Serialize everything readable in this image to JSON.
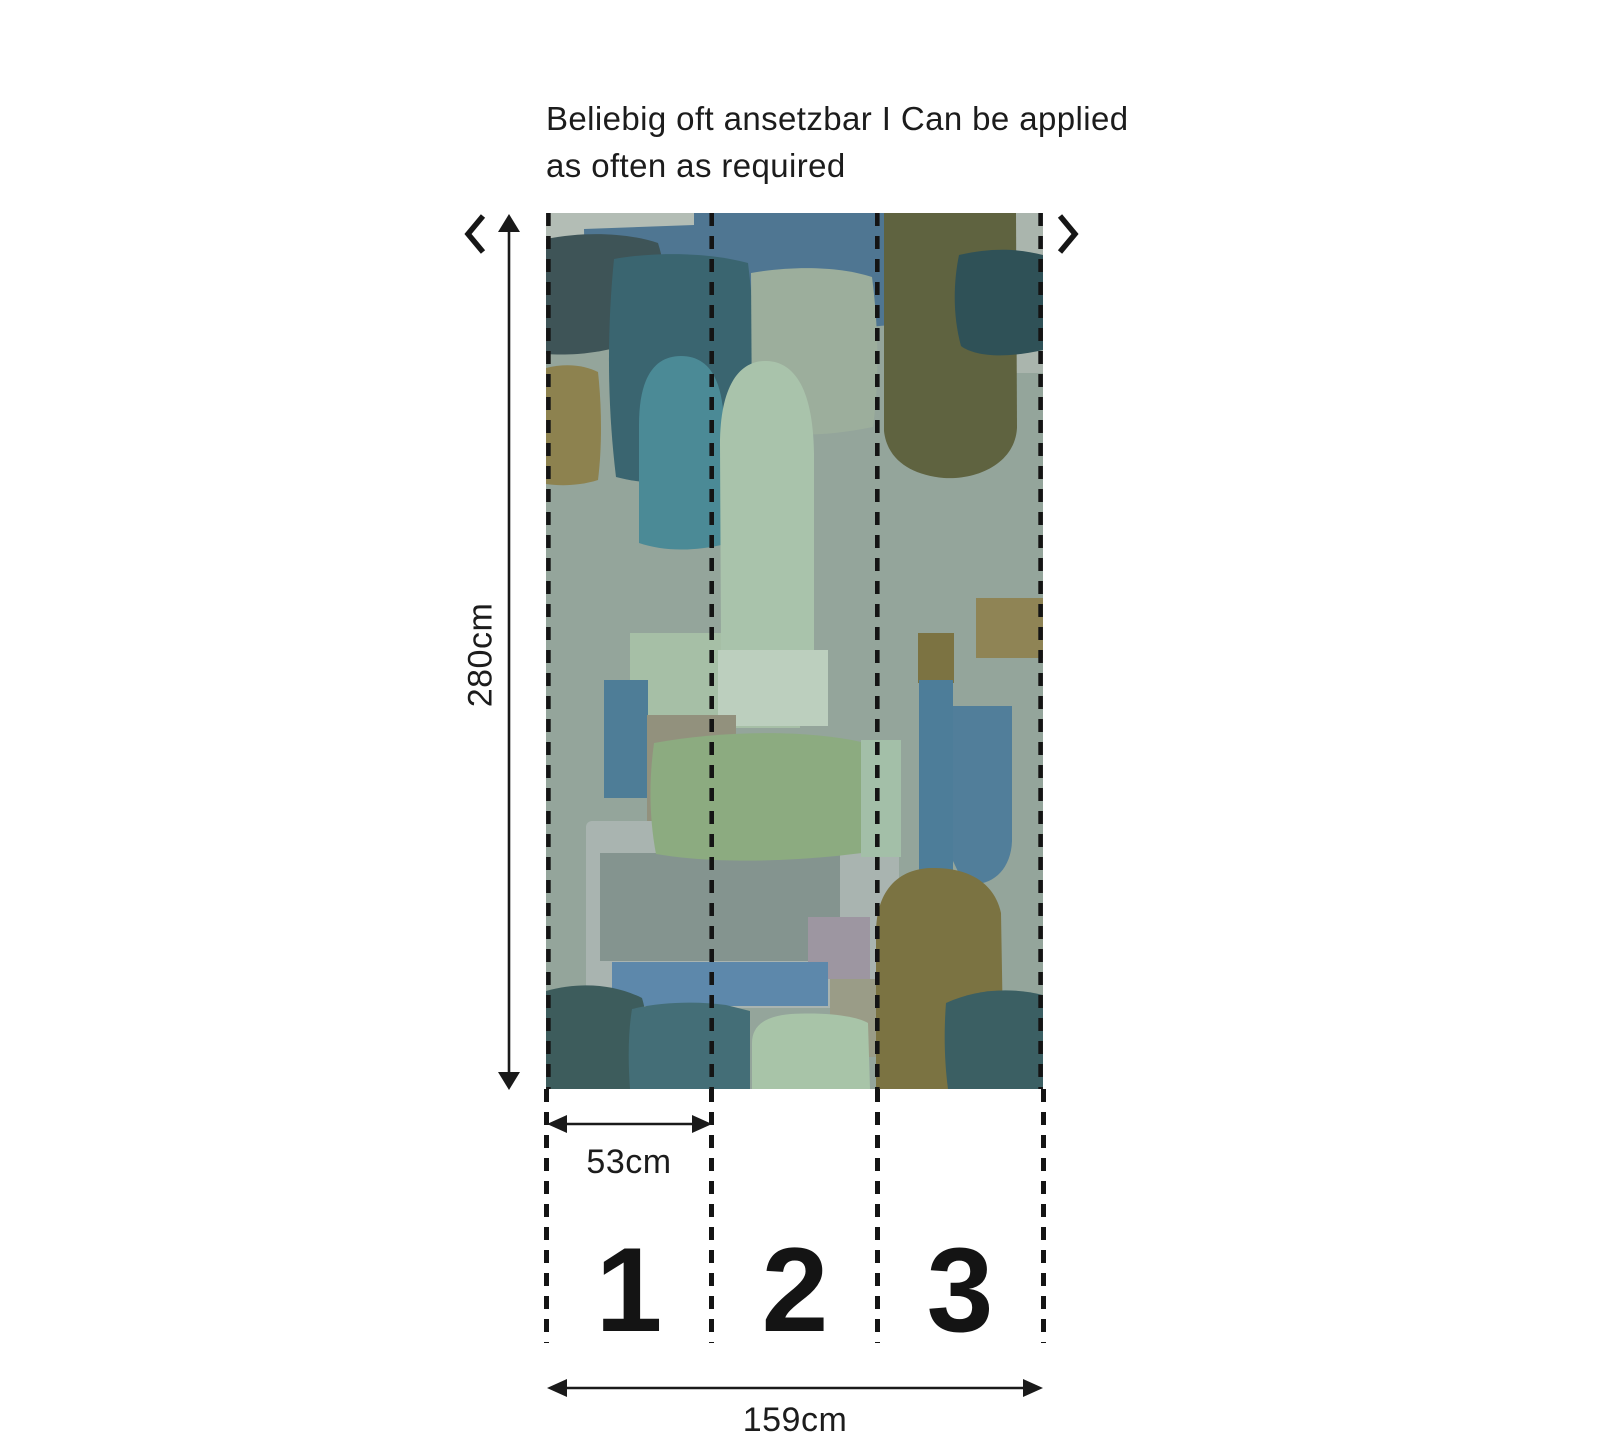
{
  "note": {
    "line1": "Beliebig oft ansetzbar I Can be applied",
    "line2": "as often as required"
  },
  "dimensions": {
    "height_label": "280cm",
    "strip_width_label": "53cm",
    "total_width_label": "159cm"
  },
  "panels": [
    {
      "number": "1"
    },
    {
      "number": "2"
    },
    {
      "number": "3"
    }
  ],
  "icons": {
    "left": "chevron-left",
    "right": "chevron-right"
  },
  "colors": {
    "text": "#1c1c1c",
    "dimension_lines": "#1a1a1a",
    "cut_dash": "#141414",
    "background": "#ffffff"
  },
  "wallpaper": {
    "width": 497,
    "height": 876,
    "dash": {
      "color": "#141414",
      "width": 4.6,
      "pattern": "13 10"
    },
    "cut_lines_x": [
      2.4,
      165.7,
      331.3,
      494.6
    ],
    "shapes": [
      {
        "t": "rect",
        "x": 0,
        "y": 0,
        "w": 497,
        "h": 876,
        "f": "#94a59b"
      },
      {
        "t": "rect",
        "x": 0,
        "y": 0,
        "w": 372,
        "h": 56,
        "f": "#b3bdb5"
      },
      {
        "t": "rect",
        "x": 430,
        "y": 0,
        "w": 67,
        "h": 160,
        "f": "#aab5ad"
      },
      {
        "t": "path",
        "d": "M38,16 L148,12 L148,0 L359,0 L359,110 C280,121 115,121 40,115 Z",
        "f": "#4f7692"
      },
      {
        "t": "path",
        "d": "M0,26 C40,18 82,20 112,30 C122,62 122,94 113,120 C68,140 28,143 0,141 Z",
        "f": "#3e5457"
      },
      {
        "t": "path",
        "d": "M68,46 C112,38 166,40 202,50 C211,122 211,200 201,263 C152,273 104,273 70,264 C61,190 61,116 68,46 Z",
        "f": "#3a6570"
      },
      {
        "t": "path",
        "d": "M205,60 C250,52 296,54 326,64 C333,118 333,170 327,214 C278,224 236,224 206,215 Z",
        "f": "#9cae9c"
      },
      {
        "t": "path",
        "d": "M338,0 L470,0 L471,215 C469,250 432,267 398,265 C364,262 341,246 338,218 Z",
        "f": "#5f6340"
      },
      {
        "t": "path",
        "d": "M413,42 C447,34 474,36 497,42 L497,137 C458,146 428,143 415,133 C407,104 407,71 413,42 Z",
        "f": "#2f5157"
      },
      {
        "t": "path",
        "d": "M0,155 C20,150 38,152 52,159 C56,196 56,234 52,267 C33,273 14,273 0,271 Z",
        "f": "#8d824f"
      },
      {
        "t": "path",
        "d": "M93,330 L93,212 C93,162 110,143 135,143 C161,143 177,163 178,213 L179,331 C148,339 116,338 93,330 Z",
        "f": "#4b8a96"
      },
      {
        "t": "rect",
        "x": 84,
        "y": 420,
        "w": 170,
        "h": 95,
        "f": "#a6bfa6"
      },
      {
        "t": "path",
        "d": "M175,437 L174,232 C174,170 195,147 221,148 C249,149 267,177 268,240 L268,437 Z",
        "f": "#a9c3ab"
      },
      {
        "t": "rect",
        "x": 172,
        "y": 437,
        "w": 110,
        "h": 76,
        "f": "#bccfbe"
      },
      {
        "t": "rect",
        "x": 58,
        "y": 467,
        "w": 44,
        "h": 118,
        "f": "#4e7d97"
      },
      {
        "t": "rect",
        "x": 101,
        "y": 502,
        "w": 89,
        "h": 118,
        "f": "#92917d"
      },
      {
        "t": "rect",
        "x": 40,
        "y": 608,
        "w": 313,
        "h": 187,
        "rx": 6,
        "f": "#a9b4b0"
      },
      {
        "t": "rect",
        "x": 54,
        "y": 640,
        "w": 240,
        "h": 108,
        "f": "#84948f"
      },
      {
        "t": "path",
        "d": "M108,530 C180,517 262,517 315,529 C321,567 321,606 316,640 C238,650 162,650 110,641 C103,604 103,566 108,530 Z",
        "f": "#8cab80"
      },
      {
        "t": "rect",
        "x": 315,
        "y": 527,
        "w": 40,
        "h": 117,
        "f": "#a3bfa8"
      },
      {
        "t": "rect",
        "x": 262,
        "y": 704,
        "w": 62,
        "h": 62,
        "f": "#9d96a1"
      },
      {
        "t": "rect",
        "x": 284,
        "y": 766,
        "w": 54,
        "h": 78,
        "f": "#9a9c87"
      },
      {
        "t": "rect",
        "x": 430,
        "y": 385,
        "w": 67,
        "h": 60,
        "f": "#8f8455"
      },
      {
        "t": "rect",
        "x": 372,
        "y": 420,
        "w": 36,
        "h": 50,
        "f": "#7c7342"
      },
      {
        "t": "rect",
        "x": 373,
        "y": 467,
        "w": 34,
        "h": 200,
        "f": "#4d7d99"
      },
      {
        "t": "path",
        "d": "M407,493 L466,493 L466,628 C465,660 441,677 417,669 L407,648 Z",
        "f": "#517e9a"
      },
      {
        "t": "path",
        "d": "M330,720 C330,680 350,656 385,655 C420,654 448,668 455,700 L458,876 L330,876 Z",
        "f": "#7b7342"
      },
      {
        "t": "rect",
        "x": 66,
        "y": 749,
        "w": 216,
        "h": 44,
        "f": "#5d88ab"
      },
      {
        "t": "path",
        "d": "M0,778 C36,768 70,772 96,785 C104,812 104,845 100,876 L0,876 Z",
        "f": "#3d5c5c"
      },
      {
        "t": "path",
        "d": "M86,796 C115,789 150,788 180,792 L204,798 L204,876 L84,876 C82,849 82,820 86,796 Z",
        "f": "#446e77"
      },
      {
        "t": "path",
        "d": "M206,876 L206,830 C206,812 220,803 245,801 C280,799 310,803 322,810 L324,876 Z",
        "f": "#a8c4a8"
      },
      {
        "t": "path",
        "d": "M400,790 C430,776 465,774 497,782 L497,876 L402,876 C398,846 398,816 400,790 Z",
        "f": "#3b5f63"
      }
    ]
  }
}
